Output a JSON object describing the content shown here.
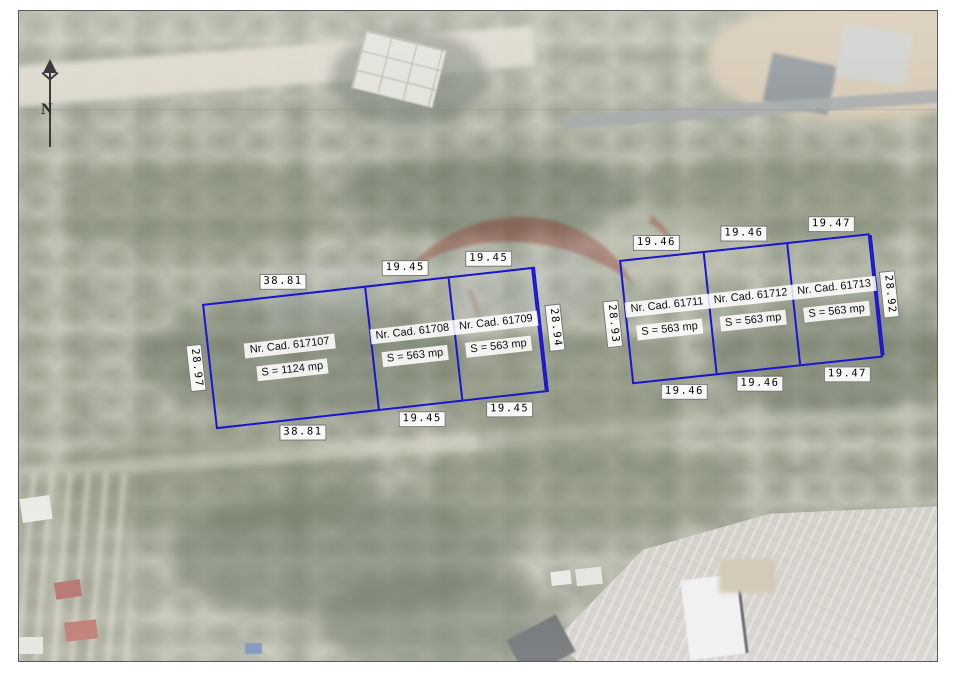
{
  "map": {
    "north_label": "N",
    "frame_color": "#5a5a5a",
    "plot_border_color": "#1a15cf",
    "watermark_color": "#8e241f"
  },
  "plot_groups": [
    {
      "name": "west-group",
      "side_left": "28.97",
      "side_right": "28.94",
      "plots": [
        {
          "cad": "Nr. Cad. 617107",
          "area": "S = 1124 mp",
          "top": "38.81",
          "bottom": "38.81"
        },
        {
          "cad": "Nr. Cad. 61708",
          "area": "S = 563 mp",
          "top": "19.45",
          "bottom": "19.45"
        },
        {
          "cad": "Nr. Cad. 61709",
          "area": "S = 563 mp",
          "top": "19.45",
          "bottom": "19.45"
        }
      ]
    },
    {
      "name": "east-group",
      "side_left": "28.93",
      "side_right": "28.92",
      "plots": [
        {
          "cad": "Nr. Cad. 61711",
          "area": "S = 563 mp",
          "top": "19.46",
          "bottom": "19.46"
        },
        {
          "cad": "Nr. Cad. 61712",
          "area": "S = 563 mp",
          "top": "19.46",
          "bottom": "19.46"
        },
        {
          "cad": "Nr. Cad. 61713",
          "area": "S = 563 mp",
          "top": "19.47",
          "bottom": "19.47"
        }
      ]
    }
  ]
}
